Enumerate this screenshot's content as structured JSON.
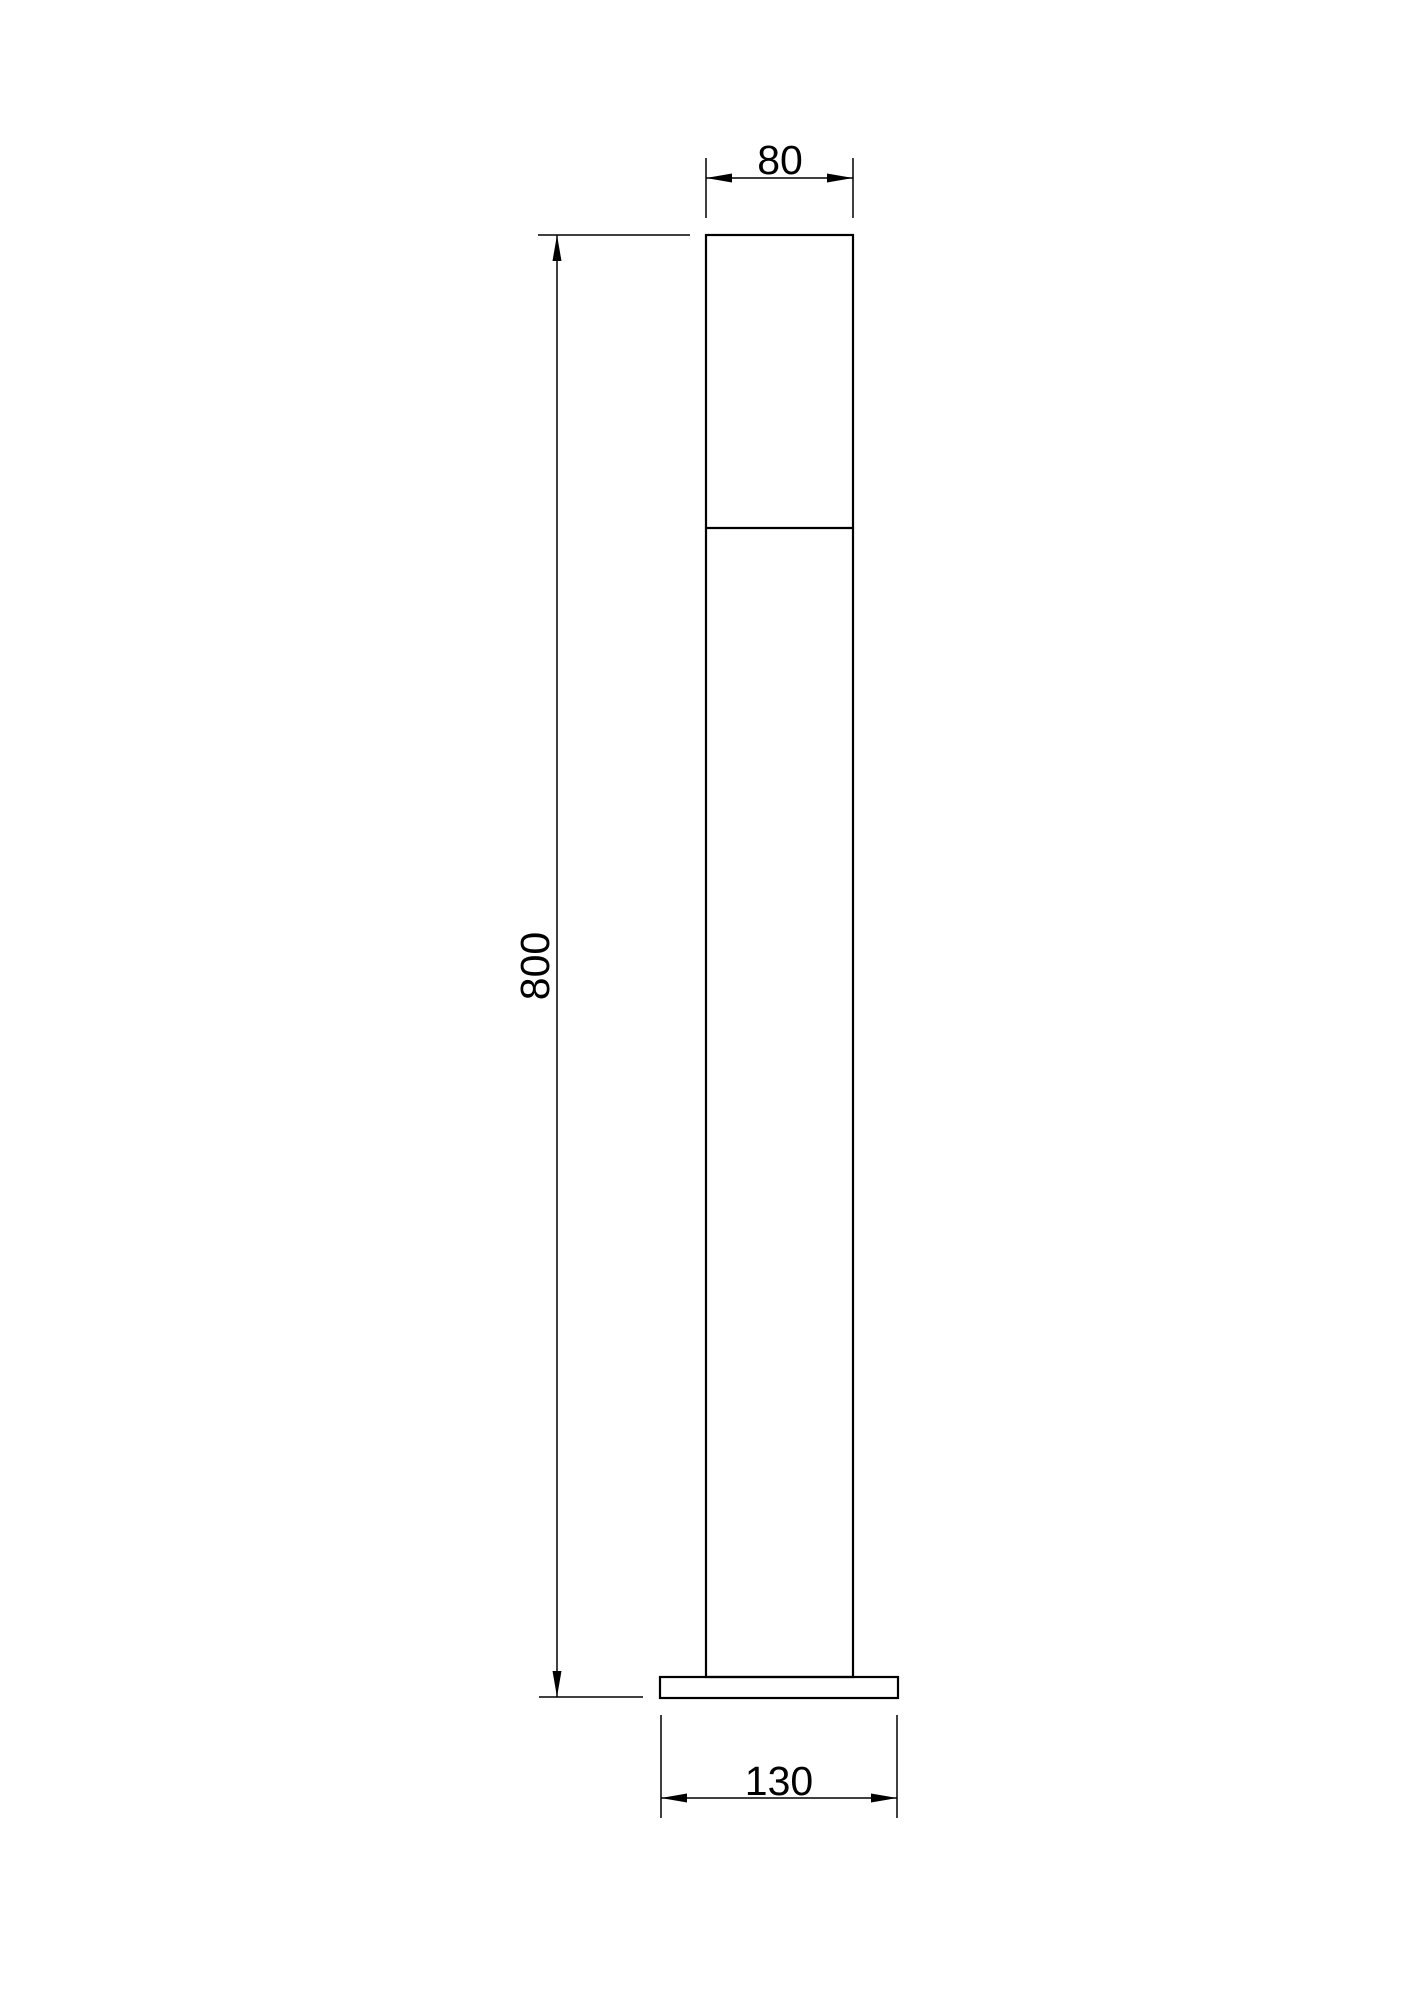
{
  "drawing": {
    "title": "bollard-light-dimension-drawing",
    "colors": {
      "line": "#000000",
      "background": "#ffffff"
    },
    "dimensions": [
      {
        "id": "head-width",
        "label": "80",
        "orientation": "horizontal",
        "position": "top"
      },
      {
        "id": "overall-height",
        "label": "800",
        "orientation": "vertical",
        "position": "left"
      },
      {
        "id": "base-width",
        "label": "130",
        "orientation": "horizontal",
        "position": "bottom"
      }
    ]
  }
}
